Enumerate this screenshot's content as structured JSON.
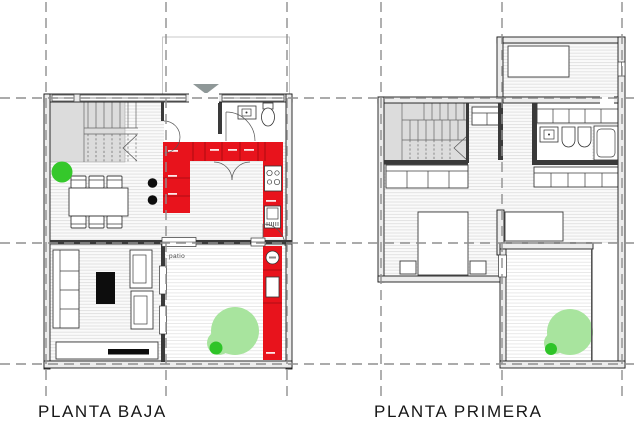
{
  "plans": [
    {
      "id": "planta-baja",
      "title": "PLANTA BAJA",
      "rooms": {
        "patio_label": "patio"
      }
    },
    {
      "id": "planta-primera",
      "title": "PLANTA PRIMERA"
    }
  ],
  "colors": {
    "background": "#ffffff",
    "kitchen_red": "#e8131c",
    "kitchen_red_dark": "#9e0b10",
    "tree_canopy_green": "#a8e49e",
    "tree_trunk_green": "#2ec428",
    "plant_green": "#35c82b",
    "stair_gray": "#dcdcdc",
    "wall_fill": "#ececec",
    "wall_line": "#1a1a1a",
    "partition_dark": "#3a3a3a",
    "grid_gray": "#8f8f8f",
    "canopy_line": "#c9c9c9",
    "entrance_arrow_gray": "#8f9898",
    "furniture_line": "#3c3c3c"
  }
}
